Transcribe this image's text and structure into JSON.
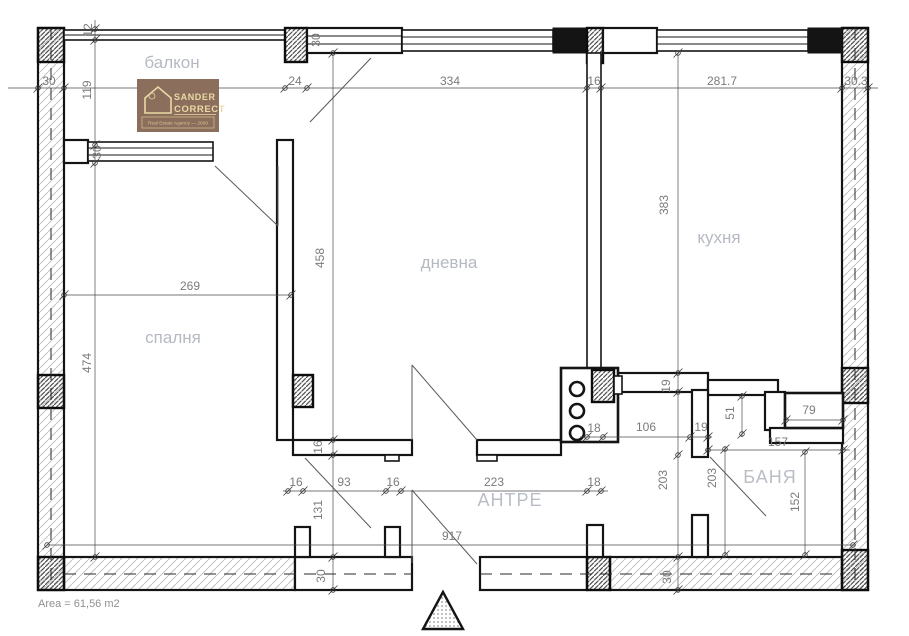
{
  "drawing": {
    "title": "apartment-floor-plan",
    "area_label": "Area = 61,56 m2",
    "rooms": {
      "balcony": "балкон",
      "bedroom": "спалня",
      "living": "дневна",
      "kitchen": "кухня",
      "hall": "АНТРЕ",
      "bath": "БАНЯ"
    },
    "logo": {
      "name_line1": "SANDER",
      "name_line2": "CORRECT",
      "tagline": "Real Estate Agency — 2000",
      "bg_color": "#8b6e5c",
      "text_color": "#ead9a5"
    },
    "dims": {
      "wall_left": "30",
      "rail": "12",
      "balcony_depth": "119",
      "balcony_window": "30",
      "door_col": "24",
      "living_width": "334",
      "partition": "16",
      "kitchen_width": "281.7",
      "wall_right": "30.3",
      "wall_top": "30",
      "living_height": "458",
      "kitchen_height": "383",
      "bedroom_width": "269",
      "bedroom_height": "474",
      "wall_mid": "16",
      "frame_left": "16",
      "bedroom_door": "93",
      "frame_right": "16",
      "hall_width": "223",
      "hall_wall": "18",
      "hall_depth": "131",
      "wall_bottom_left": "30",
      "total_width": "917",
      "shaft_wall": "18",
      "kitchen_hall": "106",
      "kitchen_wall_h": "19",
      "kitchen_wall_v": "19",
      "niche_depth": "51",
      "niche_width": "79",
      "bath_width": "157",
      "bath_height_left": "203",
      "bath_height_right": "203",
      "bath_inner": "152",
      "wall_bottom_right": "30"
    },
    "colors": {
      "wall_line": "#111111",
      "dim_text": "#7b7b7b",
      "room_text": "#b5bac2"
    }
  }
}
